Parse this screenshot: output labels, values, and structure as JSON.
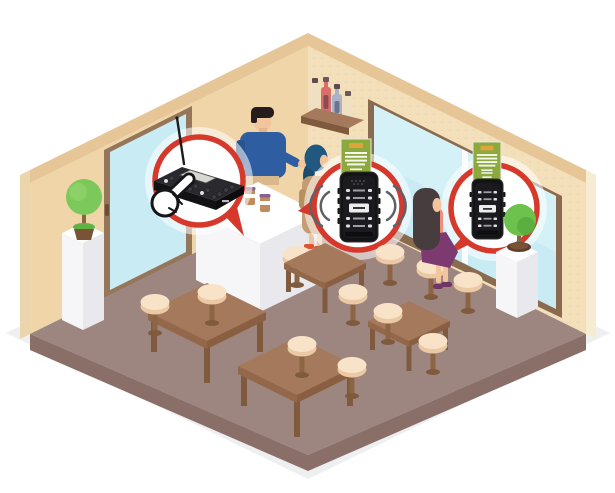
{
  "meta": {
    "title": "Isometric cafe scene illustrating a wireless guest paging system",
    "canvas_width": 615,
    "canvas_height": 493
  },
  "colors": {
    "accent": "#d6392b",
    "wall_left": "#efd5a8",
    "wall_right": "#f3dfba",
    "wall_top": "#e6c697",
    "wall_outer": "#f7ecd2",
    "floor": "#9d8680",
    "floor_side": "#8a6e68",
    "mat": "#edeff1",
    "door_frame": "#96765a",
    "window_frame": "#8a6b4f",
    "glass": "#c9ecf4",
    "glass_light": "#d8f3f8",
    "counter_top": "#ffffff",
    "counter_front": "#f6f6f8",
    "counter_side": "#e9e9ed",
    "table_top": "#a5795b",
    "table_side": "#8a5f41",
    "table_leg": "#7f5a3d",
    "stool_top": "#f8e3c9",
    "stool_side": "#eac9a4",
    "stool_leg": "#8d6544",
    "plant": "#6cc24c",
    "plant_light": "#7cc85a",
    "pot": "#7a5236",
    "banner": "#8ca93e",
    "banner_label": "#dfa43c",
    "device_body": "#141417",
    "device_face": "#1b1b1f",
    "device_screen": "#d7d9d0",
    "skin": "#f2c59d",
    "barista_shirt": "#2e5ea1",
    "barista_hair": "#241d1b",
    "customer_headscarf": "#20587f",
    "customer_dress": "#c59d72",
    "customer_shoes": "#e0512f",
    "woman_hair": "#473c3e",
    "woman_top": "#ee8f7e",
    "woman_skirt": "#7c3a71",
    "woman_shoes": "#6e3566",
    "wave": "#606066"
  },
  "scene": {
    "room": {
      "walls": 2,
      "door": "glass-door-on-left-wall",
      "window": "large-window-on-right-wall"
    },
    "callouts": [
      {
        "name": "paging-transmitter-callout",
        "shape": "red-circle-speech-bubble",
        "content": "keypad-transmitter-with-antenna",
        "extra": "hand-cursor-pressing-key"
      },
      {
        "name": "pager-ringing-callout",
        "shape": "red-circle-speech-bubble",
        "content": "coaster-pager-device",
        "extra": "signal-waves-both-sides"
      },
      {
        "name": "pager-callout",
        "shape": "red-circle-speech-bubble",
        "content": "coaster-pager-device"
      }
    ],
    "posters": [
      {
        "name": "wall-banner",
        "color": "#8ca93e",
        "text_legible": false
      },
      {
        "name": "wall-banner",
        "color": "#8ca93e",
        "text_legible": false
      }
    ],
    "people": [
      {
        "role": "barista",
        "position": "behind-counter"
      },
      {
        "role": "customer",
        "position": "standing-at-counter"
      },
      {
        "role": "customer",
        "position": "seated-by-window"
      }
    ],
    "furniture": {
      "tables": 4,
      "stools": 11,
      "plants": 2,
      "pedestals": 2,
      "shelf_bottles": 4,
      "counter_cups": 2
    }
  }
}
